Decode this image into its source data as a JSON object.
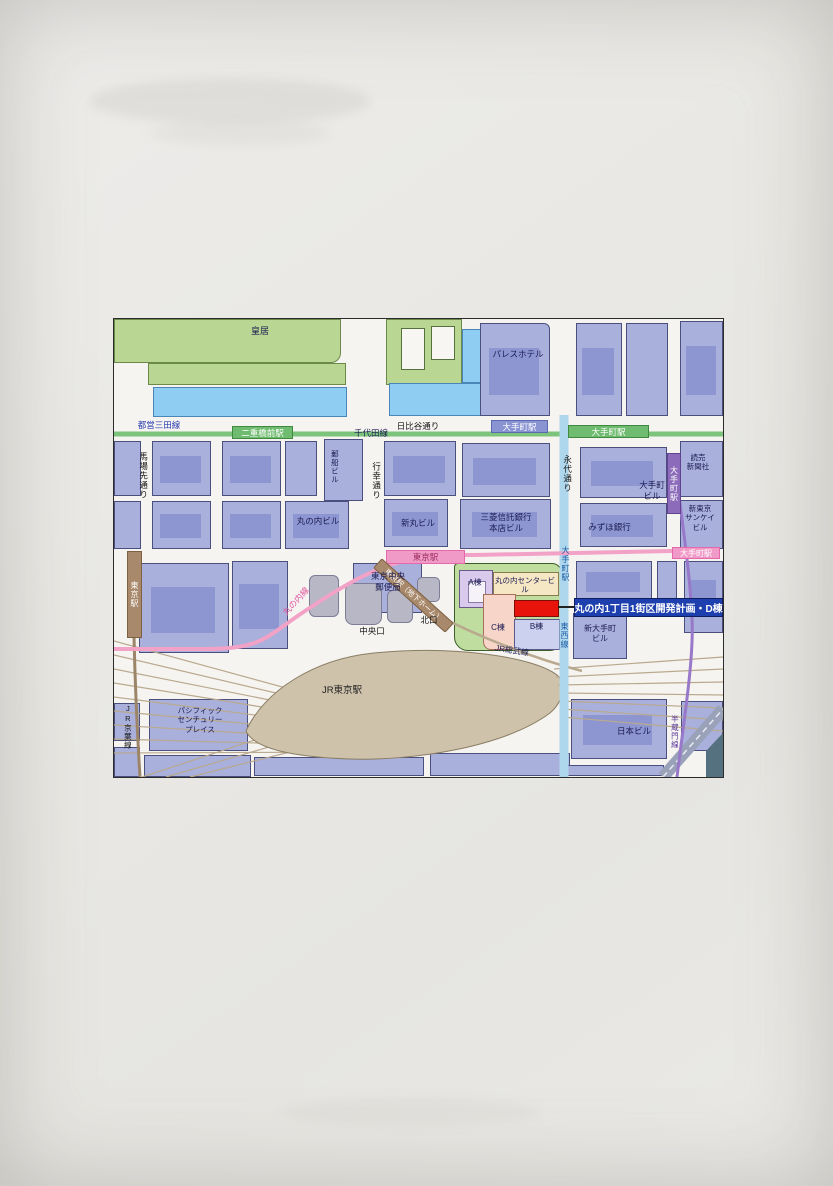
{
  "page": {
    "description": "Scanned brochure page with area access map around Tokyo Station / Marunouchi",
    "background_color": "#e9e8e4"
  },
  "map": {
    "border_color": "#2b2b2b",
    "colors": {
      "city_block": "#a9b0dc",
      "park_green": "#b9d693",
      "water_blue": "#8fcdf2",
      "jr_station_tan": "#cfc2ab",
      "dev_block_green": "#bedd9e",
      "site_red": "#e8130b",
      "callout_blue": "#1e3fae",
      "marunouchi_line_pink": "#f2a2c6",
      "mita_line_green": "#7cc47c",
      "tozai_line_blue": "#aed6ec",
      "hanzomon_line_purple": "#9878c8",
      "rail_tan": "#b9a98e"
    },
    "callout": {
      "text": "丸の内1丁目1街区開発計画・D棟"
    },
    "stations": {
      "nijubashimae": "二重橋前駅",
      "otemachi_chiyoda": "大手町駅",
      "otemachi_mita": "大手町駅",
      "otemachi_hanzomon": "大手町駅",
      "otemachi_marunouchi": "大手町駅",
      "otemachi_tozai": "大手町駅",
      "tokyo_marunouchi": "東京駅",
      "tokyo_underground": "東京駅（地下ホーム）",
      "tokyo_keiyo": "東京駅"
    },
    "lines": {
      "toei_mita": "都営三田線",
      "chiyoda": "千代田線",
      "marunouchi": "丸の内線",
      "jr_keiyo": "JR京葉線",
      "jr_sobu": "JR総武線",
      "tozai": "東西線",
      "hanzomon": "半蔵門線"
    },
    "roads": {
      "hibiya_dori": "日比谷通り",
      "babasaki_dori": "馬場先通り",
      "gyoko_dori": "行幸通り",
      "eitai_dori": "永代通り"
    },
    "places": {
      "imperial_palace": "皇居",
      "palace_hotel": "パレスホテル",
      "yusen_bldg": "郵船ビル",
      "marunouchi_bldg": "丸の内ビル",
      "shinmaru_bldg": "新丸ビル",
      "mitsubishi_trust_bldg": "三菱信託銀行\n本店ビル",
      "mizuho_bank": "みずほ銀行",
      "otemachi_bldg": "大手町\nビル",
      "yomiuri_shimbun": "読売\n新聞社",
      "shin_tokyo_sankei_bldg": "新東京\nサンケイ\nビル",
      "tokyo_central_post_office": "東京中央\n郵便局",
      "north_exit": "北口",
      "central_exit": "中央口",
      "jr_tokyo_station": "JR東京駅",
      "pacific_century_place": "パシフィック\nセンチュリー\nプレイス",
      "marunouchi_center_bldg": "丸の内センタービル",
      "bldg_a": "A棟",
      "bldg_b": "B棟",
      "bldg_c": "C棟",
      "shin_otemachi_bldg": "新大手町\nビル",
      "nippon_bldg": "日本ビル"
    }
  }
}
